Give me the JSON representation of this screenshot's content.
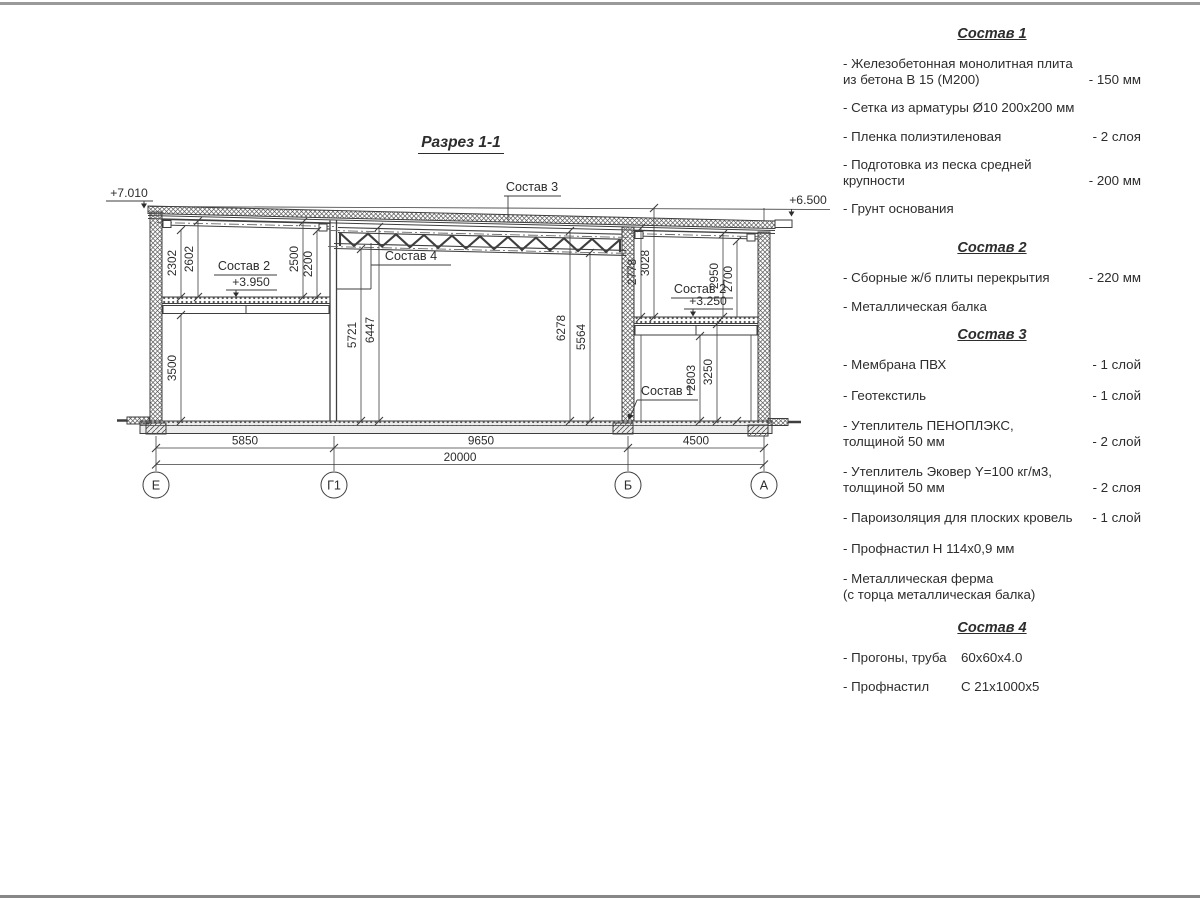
{
  "drawing": {
    "title": "Разрез 1-1",
    "elevations": {
      "roof_left": "+7.010",
      "roof_right": "+6.500",
      "slab_left": "+3.950",
      "slab_right": "+3.250"
    },
    "callouts": {
      "sostav1": "Состав 1",
      "sostav2_left": "Состав 2",
      "sostav2_right": "Состав 2",
      "sostav3": "Состав 3",
      "sostav4": "Состав 4"
    },
    "dims": {
      "d2302": "2302",
      "d2602": "2602",
      "d2500": "2500",
      "d2200": "2200",
      "d3500": "3500",
      "d5721": "5721",
      "d6447": "6447",
      "d6278": "6278",
      "d5564": "5564",
      "d2778": "2778",
      "d3028": "3028",
      "d2950": "2950",
      "d2700": "2700",
      "d2803": "2803",
      "d3250": "3250",
      "b5850": "5850",
      "b9650": "9650",
      "b4500": "4500",
      "b20000": "20000"
    },
    "axes": {
      "e": "Е",
      "g1": "Г1",
      "b": "Б",
      "a": "А"
    }
  },
  "notes": {
    "sections": [
      {
        "title": "Состав 1",
        "items": [
          {
            "text": "- Железобетонная  монолитная плита\nиз бетона В 15 (М200)",
            "value": "- 150 мм"
          },
          {
            "text": "- Сетка из арматуры Ø10 200х200 мм",
            "value": ""
          },
          {
            "text": "- Пленка полиэтиленовая",
            "value": "-  2 слоя"
          },
          {
            "text": "- Подготовка из песка средней\nкрупности",
            "value": "- 200 мм"
          },
          {
            "text": "- Грунт основания",
            "value": ""
          }
        ]
      },
      {
        "title": "Состав 2",
        "items": [
          {
            "text": "- Сборные ж/б плиты перекрытия",
            "value": "- 220 мм"
          },
          {
            "text": "- Металлическая балка",
            "value": ""
          }
        ]
      },
      {
        "title": "Состав 3",
        "items": [
          {
            "text": "- Мембрана ПВХ",
            "value": "- 1 слой"
          },
          {
            "text": "- Геотекстиль",
            "value": "- 1 слой"
          },
          {
            "text": "- Утеплитель ПЕНОПЛЭКС,\nтолщиной 50 мм",
            "value": "- 2 слой"
          },
          {
            "text": "- Утеплитель Эковер Y=100 кг/м3,\nтолщиной 50 мм",
            "value": "- 2 слоя"
          },
          {
            "text": "- Пароизоляция для плоских кровель",
            "value": "- 1 слой"
          },
          {
            "text": "- Профнастил Н 114х0,9 мм",
            "value": ""
          },
          {
            "text": "- Металлическая ферма\n(с торца металлическая балка)",
            "value": ""
          }
        ]
      },
      {
        "title": "Состав 4",
        "items": [
          {
            "text": "- Прогоны, труба",
            "value": "60х60х4.0"
          },
          {
            "text": "- Профнастил",
            "value": "С 21х1000х5"
          }
        ]
      }
    ]
  }
}
